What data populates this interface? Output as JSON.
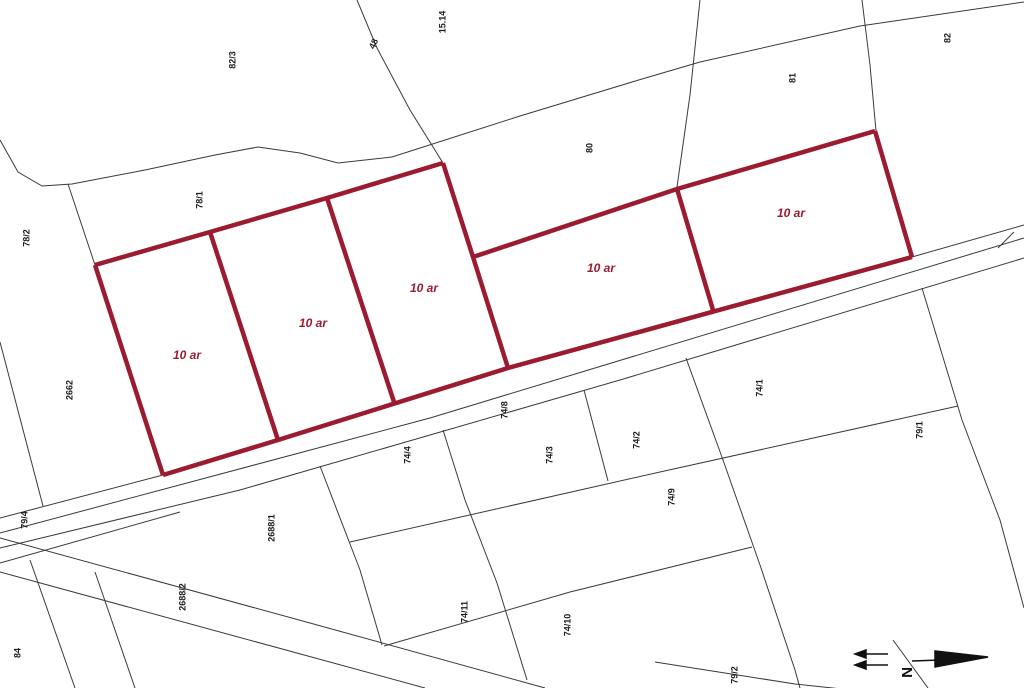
{
  "map": {
    "type": "cadastral-parcel-plan",
    "background_color": "#ffffff",
    "boundary_line_color": "#3a3a3a",
    "highlight_color": "#9b1b30",
    "parcel_labels": [
      "82/3",
      "15.14",
      "48",
      "80",
      "81",
      "82",
      "78/1",
      "78/2",
      "2662",
      "79/4",
      "84",
      "2688/1",
      "2688/2",
      "74/4",
      "74/8",
      "74/3",
      "74/2",
      "74/1",
      "74/9",
      "74/10",
      "74/11",
      "79/1",
      "79/2"
    ],
    "highlighted_parcels": {
      "count": 5,
      "area_labels": [
        "10 ar",
        "10 ar",
        "10 ar",
        "10 ar",
        "10 ar"
      ]
    },
    "north_arrow": {
      "letter": "N"
    }
  }
}
